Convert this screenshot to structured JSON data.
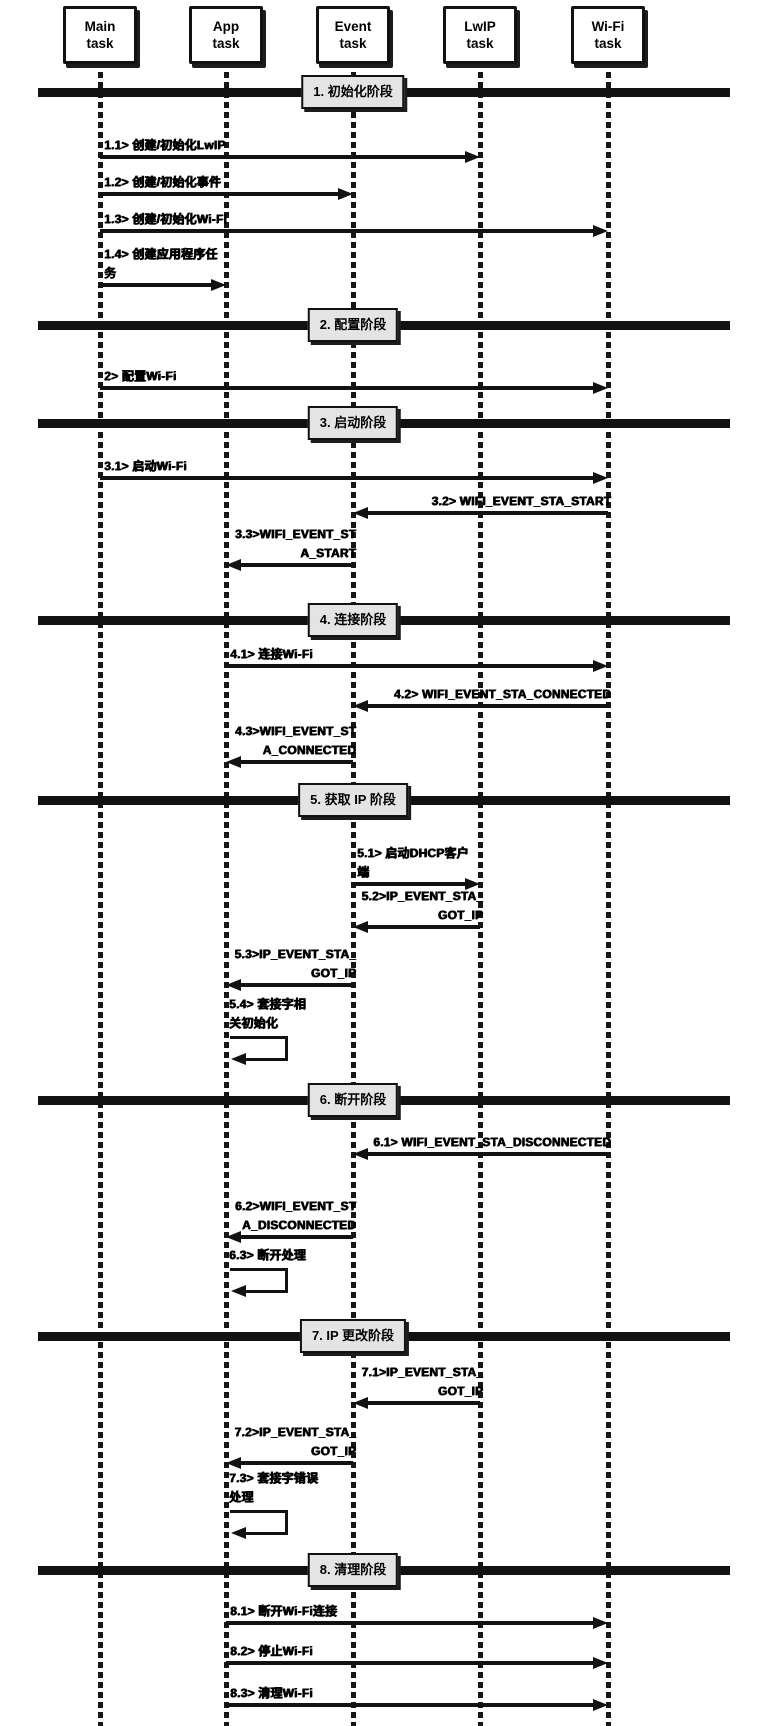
{
  "diagram": {
    "type": "sequence",
    "participants": [
      {
        "id": "main",
        "lines": [
          "Main",
          "task"
        ],
        "x": 100
      },
      {
        "id": "app",
        "lines": [
          "App",
          "task"
        ],
        "x": 226
      },
      {
        "id": "event",
        "lines": [
          "Event",
          "task"
        ],
        "x": 353
      },
      {
        "id": "lwip",
        "lines": [
          "LwIP",
          "task"
        ],
        "x": 480
      },
      {
        "id": "wifi",
        "lines": [
          "Wi-Fi",
          "task"
        ],
        "x": 608
      }
    ],
    "phases": [
      {
        "label": "1. 初始化阶段",
        "y": 92
      },
      {
        "label": "2. 配置阶段",
        "y": 325
      },
      {
        "label": "3. 启动阶段",
        "y": 423
      },
      {
        "label": "4. 连接阶段",
        "y": 620
      },
      {
        "label": "5. 获取 IP 阶段",
        "y": 800
      },
      {
        "label": "6. 断开阶段",
        "y": 1100
      },
      {
        "label": "7. IP 更改阶段",
        "y": 1336
      },
      {
        "label": "8. 清理阶段",
        "y": 1570
      }
    ],
    "messages": [
      {
        "id": "1.1",
        "lines": [
          "1.1> 创建/初始化LwIP"
        ],
        "from": "main",
        "to": "lwip",
        "y": 157
      },
      {
        "id": "1.2",
        "lines": [
          "1.2> 创建/初始化事件"
        ],
        "from": "main",
        "to": "event",
        "y": 194
      },
      {
        "id": "1.3",
        "lines": [
          "1.3> 创建/初始化Wi-Fi"
        ],
        "from": "main",
        "to": "wifi",
        "y": 231
      },
      {
        "id": "1.4",
        "lines": [
          "1.4> 创建应用程序任",
          "务"
        ],
        "from": "main",
        "to": "app",
        "y": 285
      },
      {
        "id": "2",
        "lines": [
          "2> 配置Wi-Fi"
        ],
        "from": "main",
        "to": "wifi",
        "y": 388
      },
      {
        "id": "3.1",
        "lines": [
          "3.1> 启动Wi-Fi"
        ],
        "from": "main",
        "to": "wifi",
        "y": 478
      },
      {
        "id": "3.2",
        "lines": [
          "3.2> WIFI_EVENT_STA_START"
        ],
        "from": "wifi",
        "to": "event",
        "y": 513
      },
      {
        "id": "3.3",
        "lines": [
          "3.3>WIFI_EVENT_ST",
          "A_START"
        ],
        "from": "event",
        "to": "app",
        "y": 565
      },
      {
        "id": "4.1",
        "lines": [
          "4.1> 连接Wi-Fi"
        ],
        "from": "app",
        "to": "wifi",
        "y": 666
      },
      {
        "id": "4.2",
        "lines": [
          "4.2> WIFI_EVENT_STA_CONNECTED"
        ],
        "from": "wifi",
        "to": "event",
        "y": 706
      },
      {
        "id": "4.3",
        "lines": [
          "4.3>WIFI_EVENT_ST",
          "A_CONNECTED"
        ],
        "from": "event",
        "to": "app",
        "y": 762
      },
      {
        "id": "5.1",
        "lines": [
          "5.1> 启动DHCP客户",
          "端"
        ],
        "from": "event",
        "to": "lwip",
        "y": 884
      },
      {
        "id": "5.2",
        "lines": [
          "5.2>IP_EVENT_STA_",
          "GOT_IP"
        ],
        "from": "lwip",
        "to": "event",
        "y": 927
      },
      {
        "id": "5.3",
        "lines": [
          "5.3>IP_EVENT_STA_",
          "GOT_IP"
        ],
        "from": "event",
        "to": "app",
        "y": 985
      },
      {
        "id": "5.4",
        "lines": [
          "5.4> 套接字相",
          "关初始化"
        ],
        "self": "app",
        "y": 1036
      },
      {
        "id": "6.1",
        "lines": [
          "6.1> WIFI_EVENT_STA_DISCONNECTED"
        ],
        "from": "wifi",
        "to": "event",
        "y": 1154
      },
      {
        "id": "6.2",
        "lines": [
          "6.2>WIFI_EVENT_ST",
          "A_DISCONNECTED"
        ],
        "from": "event",
        "to": "app",
        "y": 1237
      },
      {
        "id": "6.3",
        "lines": [
          "6.3> 断开处理"
        ],
        "self": "app",
        "y": 1268
      },
      {
        "id": "7.1",
        "lines": [
          "7.1>IP_EVENT_STA_",
          "GOT_IP"
        ],
        "from": "lwip",
        "to": "event",
        "y": 1403
      },
      {
        "id": "7.2",
        "lines": [
          "7.2>IP_EVENT_STA_",
          "GOT_IP"
        ],
        "from": "event",
        "to": "app",
        "y": 1463
      },
      {
        "id": "7.3",
        "lines": [
          "7.3> 套接字错误",
          "处理"
        ],
        "self": "app",
        "y": 1510
      },
      {
        "id": "8.1",
        "lines": [
          "8.1> 断开Wi-Fi连接"
        ],
        "from": "app",
        "to": "wifi",
        "y": 1623
      },
      {
        "id": "8.2",
        "lines": [
          "8.2> 停止Wi-Fi"
        ],
        "from": "app",
        "to": "wifi",
        "y": 1663
      },
      {
        "id": "8.3",
        "lines": [
          "8.3> 清理Wi-Fi"
        ],
        "from": "app",
        "to": "wifi",
        "y": 1705
      }
    ],
    "colors": {
      "line": "#121212",
      "phase_box_bg": "#e4e4e4",
      "participant_box_bg": "#ffffff",
      "text": "#000000",
      "background": "#ffffff"
    }
  }
}
